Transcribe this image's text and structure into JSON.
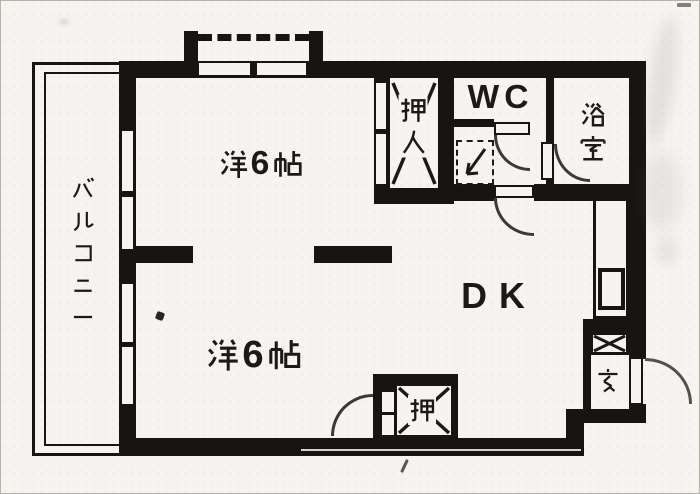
{
  "floorplan": {
    "unit_labels": {
      "balcony": "バルコニー",
      "room_upper": "洋6帖",
      "room_lower": "洋6帖",
      "dining_kitchen": "DK",
      "toilet": "WC",
      "bath": "浴室",
      "closet_upper": "押入",
      "closet_lower": "押",
      "entrance": "玄"
    },
    "fixtures": {
      "washing_machine_pan": "洗濯機置場",
      "kitchen_sink": "流し台",
      "shoe_box": "下駄箱"
    },
    "colors": {
      "wall": "#171412",
      "paper": "#f6f4f1",
      "door_arc": "#3c3835"
    }
  }
}
